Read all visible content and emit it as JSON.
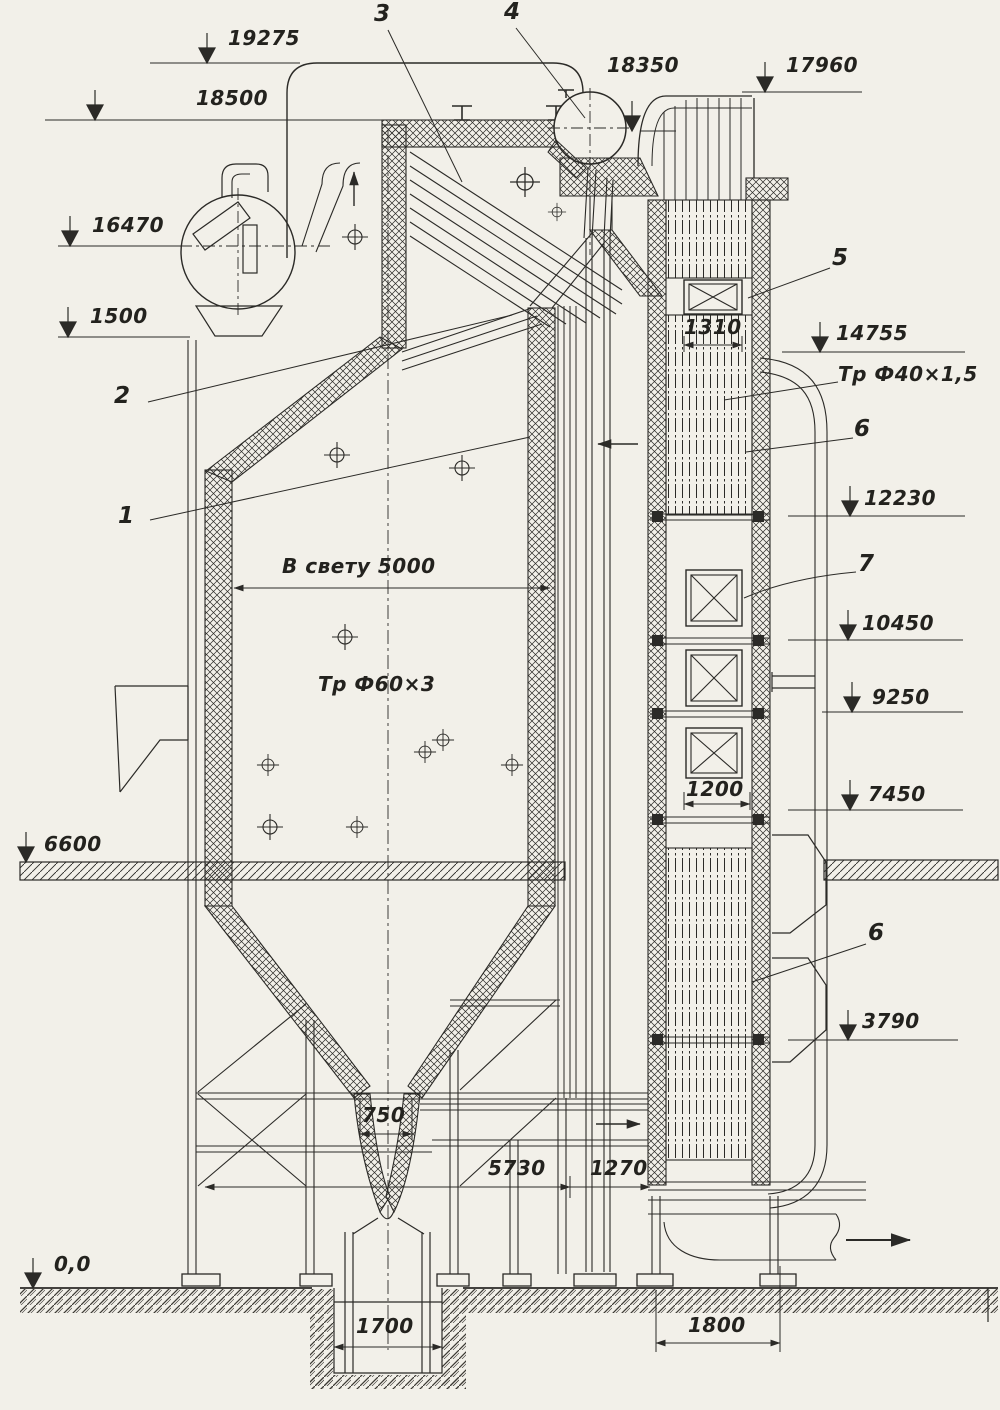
{
  "drawing": {
    "elevation_marks": {
      "e19275": "19275",
      "e18500": "18500",
      "e18350": "18350",
      "e17960": "17960",
      "e16470": "16470",
      "e1500": "1500",
      "e14755": "14755",
      "e12230": "12230",
      "e10450": "10450",
      "e9250": "9250",
      "e7450": "7450",
      "e6600": "6600",
      "e3790": "3790",
      "e00": "0,0"
    },
    "part_labels": {
      "p1": "1",
      "p2": "2",
      "p3": "3",
      "p4": "4",
      "p5": "5",
      "p6_upper": "6",
      "p6_lower": "6",
      "p7": "7"
    },
    "dimensions": {
      "d1310": "1310",
      "d5000": "В свету 5000",
      "d1200": "1200",
      "d750": "750",
      "d5730": "5730",
      "d1270": "1270",
      "d1700": "1700",
      "d1800": "1800"
    },
    "annotations": {
      "tube60": "Тр Ф60×3",
      "tube40": "Тр Ф40×1,5"
    },
    "colors": {
      "ink": "#2b2a27",
      "paper": "#f2f0e9"
    }
  }
}
